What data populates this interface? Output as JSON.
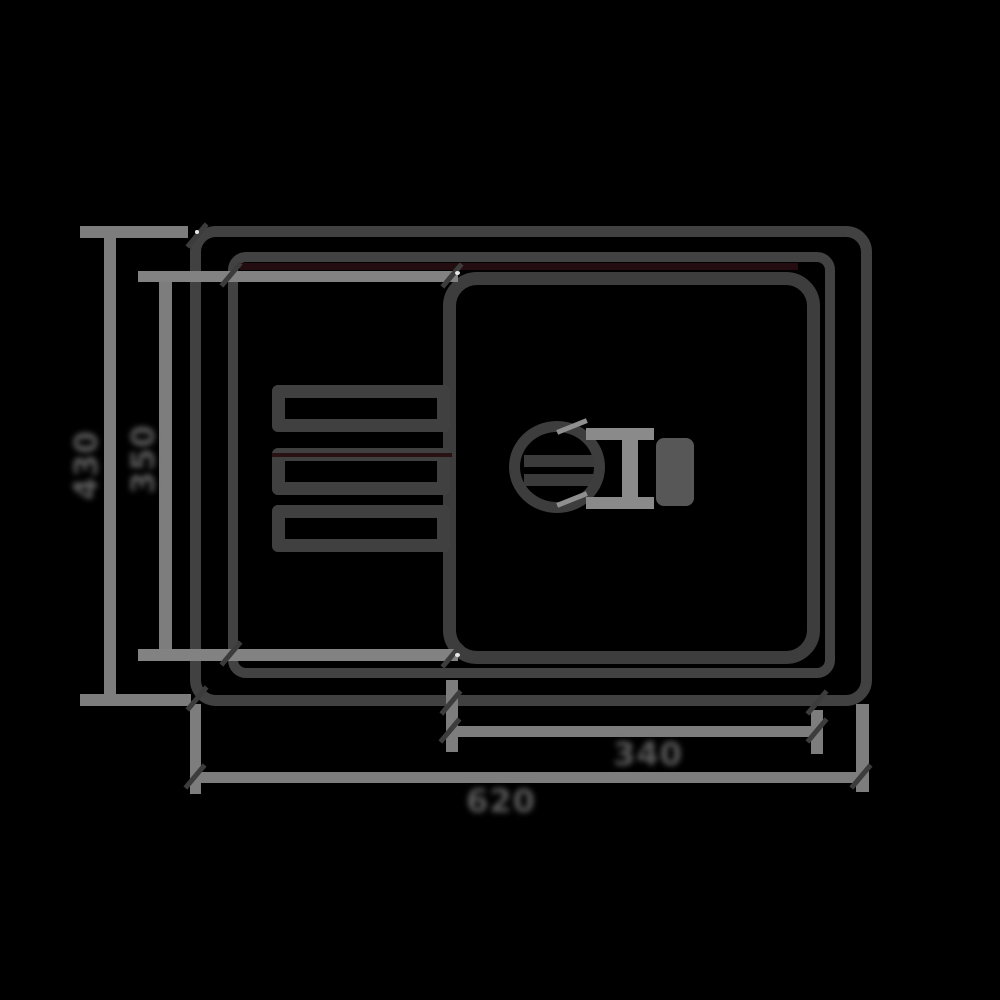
{
  "page": {
    "background": "#000000",
    "subject": "Technical top-view line drawing of a kitchen sink with left drainboard, right bowl with drain fitting, and four dimension lines"
  },
  "palette": {
    "outline_dark": "#414141",
    "bowl_outline": "#3d3d3d",
    "dimension_gray": "#7d7d7d",
    "label_gray": "#595959",
    "fitting_gray": "#8a8a8a",
    "knob_gray": "#575757",
    "accent_maroon": "#240d10"
  },
  "dimensions": {
    "overall_width_label": "620",
    "overall_depth_label": "430",
    "bowl_width_label": "340",
    "bowl_depth_label": "350"
  }
}
